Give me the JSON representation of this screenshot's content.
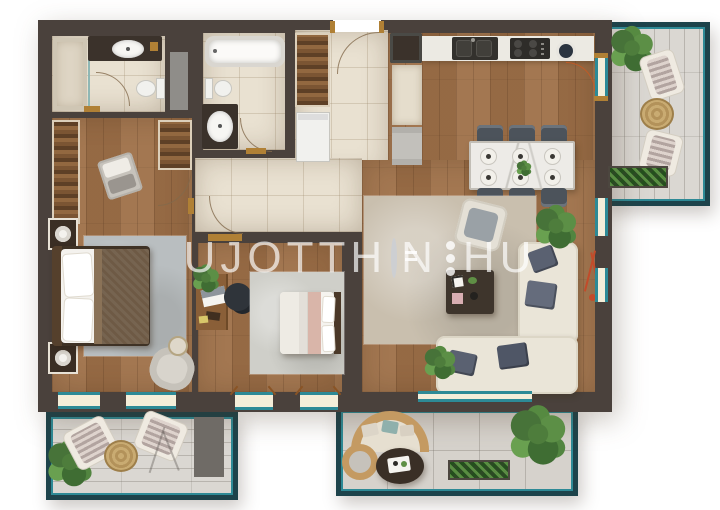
{
  "watermark": {
    "text": "UJOTTHON.HU",
    "left": "UJOTTH",
    "mid": "N",
    "right": "HU"
  },
  "palette": {
    "wall": "#4a413c",
    "wood_floor": "#9e7048",
    "tile_floor": "#e9e1d1",
    "balcony_deck": "#dad7d2",
    "terrace_stone": "#d6d2cc",
    "teal_accent": "#2d8a96",
    "railing": "#1d434b",
    "window_pane": "#f4eed9",
    "gold_sill": "#b08035",
    "sofa_cream": "#eae5d8",
    "pillow_navy": "#5a6171",
    "rug_master": "#b9bec0",
    "rug_living": "#c9bfae",
    "bed_blanket": "#6e5a45",
    "bed2_pink": "#d9b5a9",
    "plant_green": "#4e7d3c",
    "lamp_red": "#c24b2a"
  },
  "plan": {
    "type": "apartment-floorplan-top-view",
    "rooms": [
      {
        "name": "bathroom-1",
        "items": [
          "shower",
          "vanity-sink",
          "toilet",
          "door-swing"
        ]
      },
      {
        "name": "bathroom-2",
        "items": [
          "bathtub",
          "toilet",
          "vanity-sink",
          "door-swing"
        ]
      },
      {
        "name": "entry-hall",
        "items": [
          "entrance-door",
          "wardrobe",
          "washing-machine",
          "fridge",
          "tall-cabinet",
          "dryer"
        ]
      },
      {
        "name": "kitchen-dining",
        "items": [
          "counter-with-sink",
          "cooktop",
          "bowl",
          "dining-table",
          "six-chairs",
          "six-place-settings",
          "centerpiece-plant"
        ]
      },
      {
        "name": "living-room",
        "items": [
          "corner-sofa",
          "coffee-table",
          "armchair",
          "media-wall",
          "side-tray",
          "rug",
          "plants",
          "floor-lamp"
        ]
      },
      {
        "name": "master-bedroom",
        "items": [
          "double-bed",
          "nightstands-with-lamps",
          "wardrobes",
          "bench",
          "rug",
          "armchair",
          "side-table"
        ]
      },
      {
        "name": "bedroom-2",
        "items": [
          "single-bed",
          "desk-with-laptop",
          "office-chair",
          "rug",
          "plant"
        ]
      },
      {
        "name": "balcony-top-right",
        "items": [
          "two-lounge-chairs",
          "round-wicker-table",
          "plant",
          "planter-box"
        ]
      },
      {
        "name": "balcony-bottom-left",
        "items": [
          "two-lounge-chairs",
          "round-wicker-table",
          "plant",
          "privacy-screen"
        ]
      },
      {
        "name": "terrace-bottom",
        "items": [
          "curved-rattan-bench",
          "round-rattan-chair",
          "oval-table-with-tray",
          "planter-box",
          "plants"
        ]
      }
    ]
  }
}
